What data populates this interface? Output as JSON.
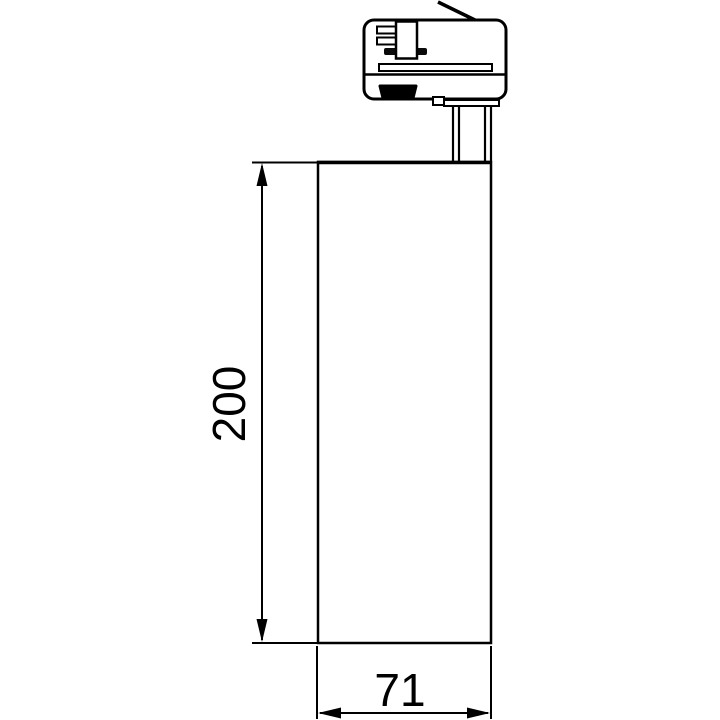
{
  "drawing": {
    "background_color": "#ffffff",
    "line_color": "#000000",
    "dimensions": {
      "height": "200",
      "width": "71"
    }
  }
}
